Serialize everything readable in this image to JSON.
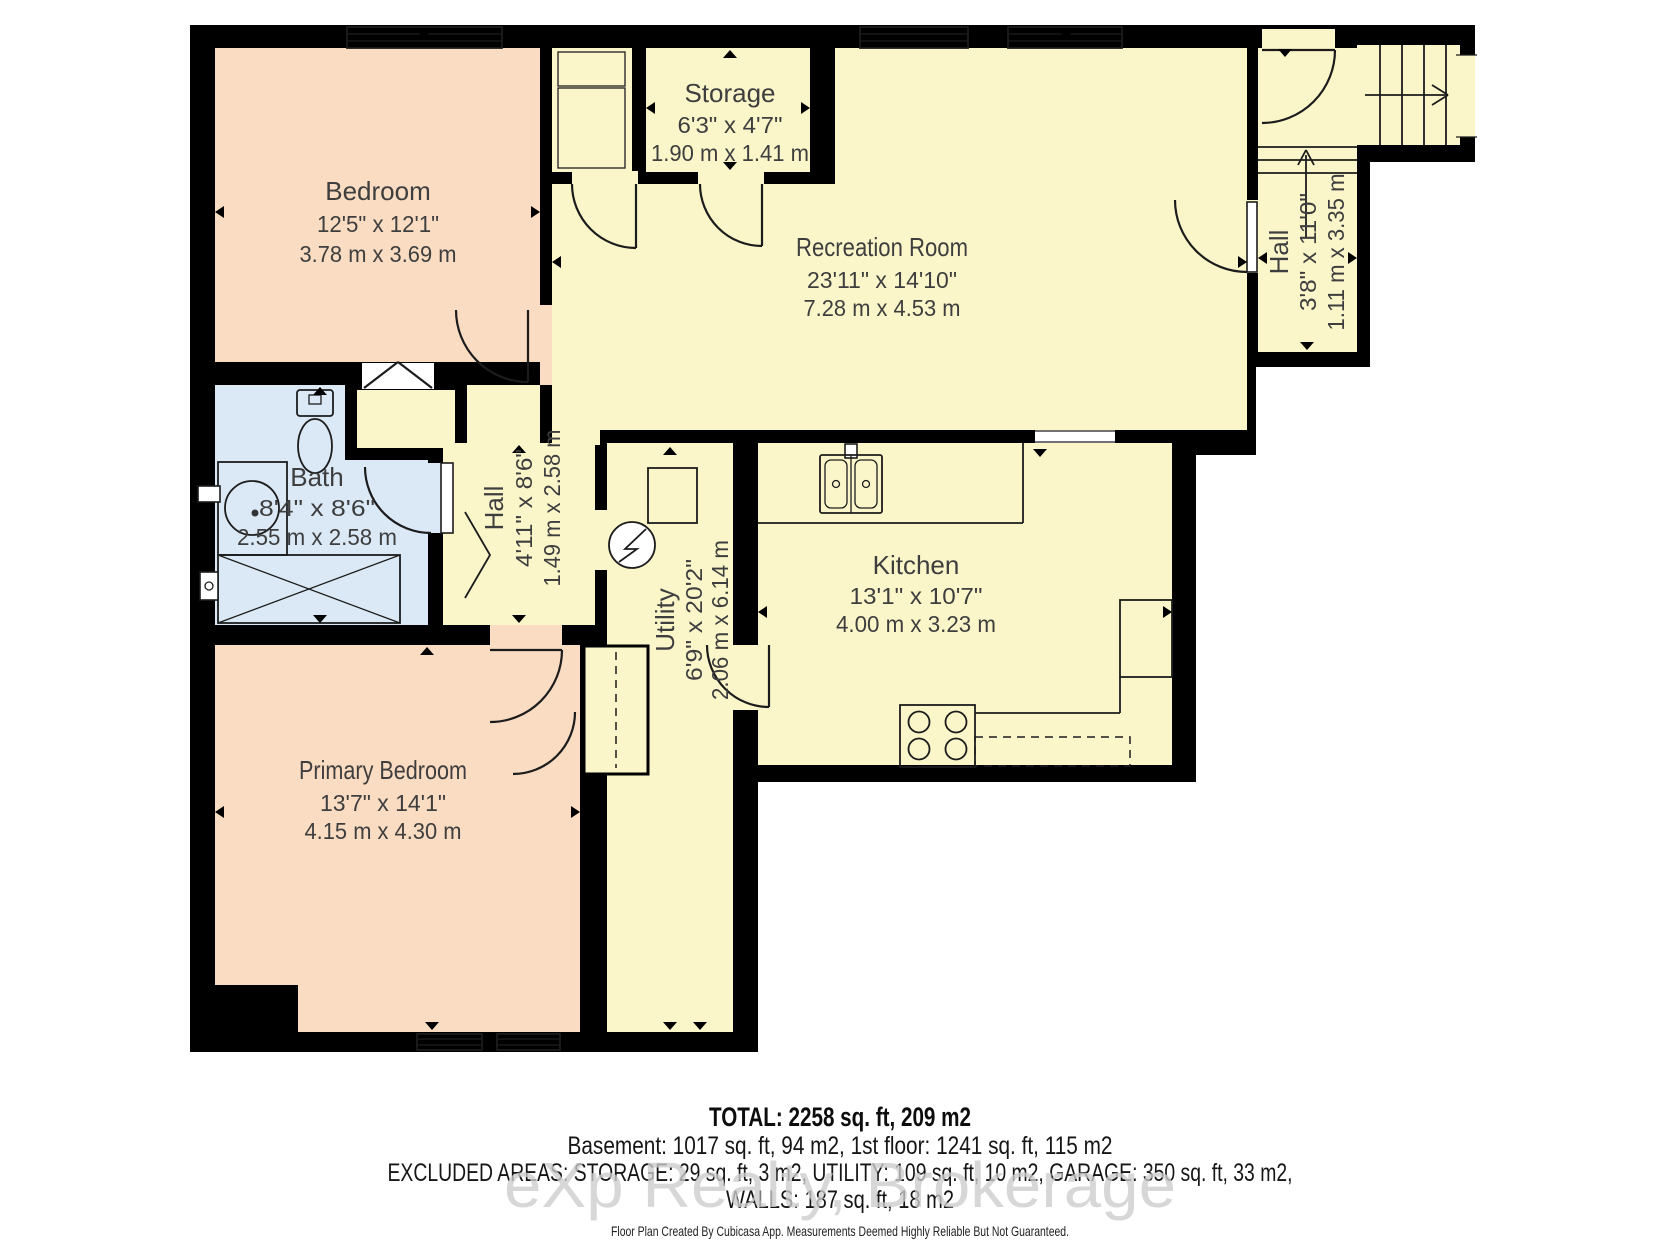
{
  "rooms": {
    "bedroom": {
      "name": "Bedroom",
      "imperial": "12'5\" x 12'1\"",
      "metric": "3.78 m x 3.69 m"
    },
    "storage": {
      "name": "Storage",
      "imperial": "6'3\" x 4'7\"",
      "metric": "1.90 m x 1.41 m"
    },
    "recreation": {
      "name": "Recreation Room",
      "imperial": "23'11\" x 14'10\"",
      "metric": "7.28 m x 4.53 m"
    },
    "hall_right": {
      "name": "Hall",
      "imperial": "3'8\" x 11'0\"",
      "metric": "1.11 m x 3.35 m"
    },
    "bath": {
      "name": "Bath",
      "imperial": "8'4\" x 8'6\"",
      "metric": "2.55 m x 2.58 m"
    },
    "hall_middle": {
      "name": "Hall",
      "imperial": "4'11\" x 8'6\"",
      "metric": "1.49 m x 2.58 m"
    },
    "utility": {
      "name": "Utility",
      "imperial": "6'9\" x 20'2\"",
      "metric": "2.06 m x 6.14 m"
    },
    "kitchen": {
      "name": "Kitchen",
      "imperial": "13'1\" x 10'7\"",
      "metric": "4.00 m x 3.23 m"
    },
    "primary_bedroom": {
      "name": "Primary Bedroom",
      "imperial": "13'7\" x 14'1\"",
      "metric": "4.15 m x 4.30 m"
    }
  },
  "summary": {
    "total": "TOTAL: 2258 sq. ft, 209 m2",
    "floors": "Basement: 1017 sq. ft, 94 m2, 1st floor: 1241 sq. ft, 115 m2",
    "excluded": "EXCLUDED AREAS: STORAGE: 29 sq. ft, 3 m2, UTILITY: 109 sq. ft, 10 m2, GARAGE: 350 sq. ft, 33 m2,",
    "walls": "WALLS: 187 sq. ft, 18 m2"
  },
  "watermark": "eXp Realty, Brokerage",
  "disclaimer": "Floor Plan Created By Cubicasa App. Measurements Deemed Highly Reliable But Not Guaranteed.",
  "colors": {
    "wall": "#000000",
    "room_yellow": "#fbf6ca",
    "room_peach": "#f9dcc2",
    "room_blue": "#dbe9f6",
    "label_text": "#3e3e3e",
    "watermark_gray": "#cdcdcd"
  }
}
